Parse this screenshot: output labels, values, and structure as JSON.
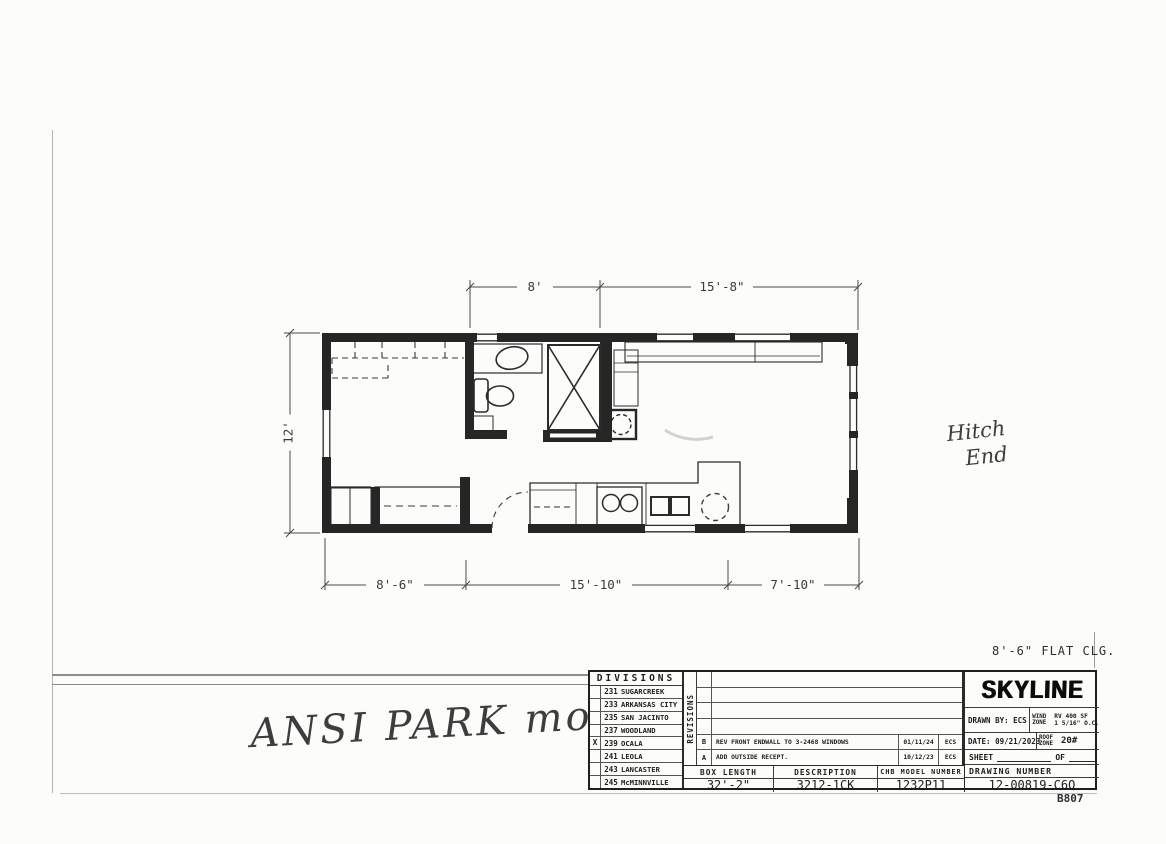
{
  "notes": {
    "ceiling": "8'-6\" FLAT CLG.",
    "page_code": "B807"
  },
  "handwriting": {
    "model_note": "ANSI PARK modeL",
    "hitch_line1": "Hitch",
    "hitch_line2": "End"
  },
  "floor_plan": {
    "dim_top": [
      "8'",
      "15'-8\""
    ],
    "dim_left": "12'",
    "dim_bottom": [
      "8'-6\"",
      "15'-10\"",
      "7'-10\""
    ]
  },
  "title_block": {
    "divisions": {
      "header": "DIVISIONS",
      "items": [
        {
          "mark": "",
          "code": "231",
          "name": "SUGARCREEK"
        },
        {
          "mark": "",
          "code": "233",
          "name": "ARKANSAS CITY"
        },
        {
          "mark": "",
          "code": "235",
          "name": "SAN JACINTO"
        },
        {
          "mark": "",
          "code": "237",
          "name": "WOODLAND"
        },
        {
          "mark": "X",
          "code": "239",
          "name": "OCALA"
        },
        {
          "mark": "",
          "code": "241",
          "name": "LEOLA"
        },
        {
          "mark": "",
          "code": "243",
          "name": "LANCASTER"
        },
        {
          "mark": "",
          "code": "245",
          "name": "McMINNVILLE"
        }
      ]
    },
    "revisions_label": "REVISIONS",
    "revisions": [
      {
        "letter": "B",
        "description": "REV FRONT ENDWALL TO 3-2468 WINDOWS",
        "date": "01/11/24",
        "by": "ECS"
      },
      {
        "letter": "A",
        "description": "ADD OUTSIDE RECEPT.",
        "date": "10/12/23",
        "by": "ECS"
      }
    ],
    "company": "SKYLINE",
    "drawn_by": "DRAWN BY: ECS",
    "date": "DATE: 09/21/2023",
    "wind_zone_label": "WIND ZONE",
    "wind_zone_value1": "RV 400 SF",
    "wind_zone_value2": "1 5/16\" O.C.",
    "roof_zone_label": "ROOF ZONE",
    "roof_zone_value": "20#",
    "sheet_label": "SHEET",
    "of_label": "OF",
    "box_length_label": "BOX LENGTH",
    "box_length_value": "32'-2\"",
    "description_label": "DESCRIPTION",
    "description_value": "3212-1CK",
    "model_label": "CHB MODEL NUMBER",
    "model_value": "1232P11",
    "drawing_number_label": "DRAWING NUMBER",
    "drawing_number_value": "12-00819-C6Q"
  }
}
